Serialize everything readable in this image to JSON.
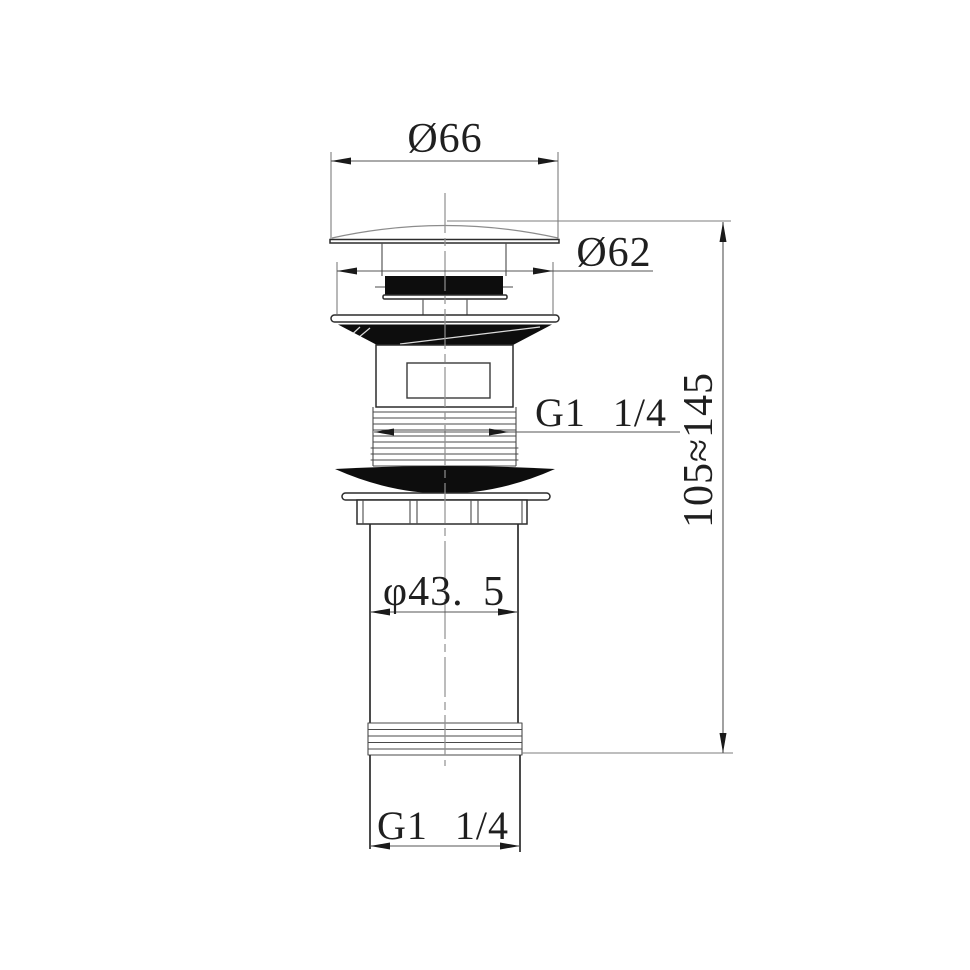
{
  "drawing": {
    "kind": "dimensioned technical drawing",
    "colors": {
      "background": "#ffffff",
      "ink": "#1f1f1f",
      "object_line": "#2c2c2c",
      "solid_fill": "#0d0d0d"
    },
    "dimensions": {
      "cap_diameter": "Ø66",
      "flange_diameter": "Ø62",
      "body_thread": "G1 1/4",
      "tail_diameter": "φ43. 5",
      "overall_height": "105≈145",
      "tail_thread": "G1 1/4"
    }
  }
}
